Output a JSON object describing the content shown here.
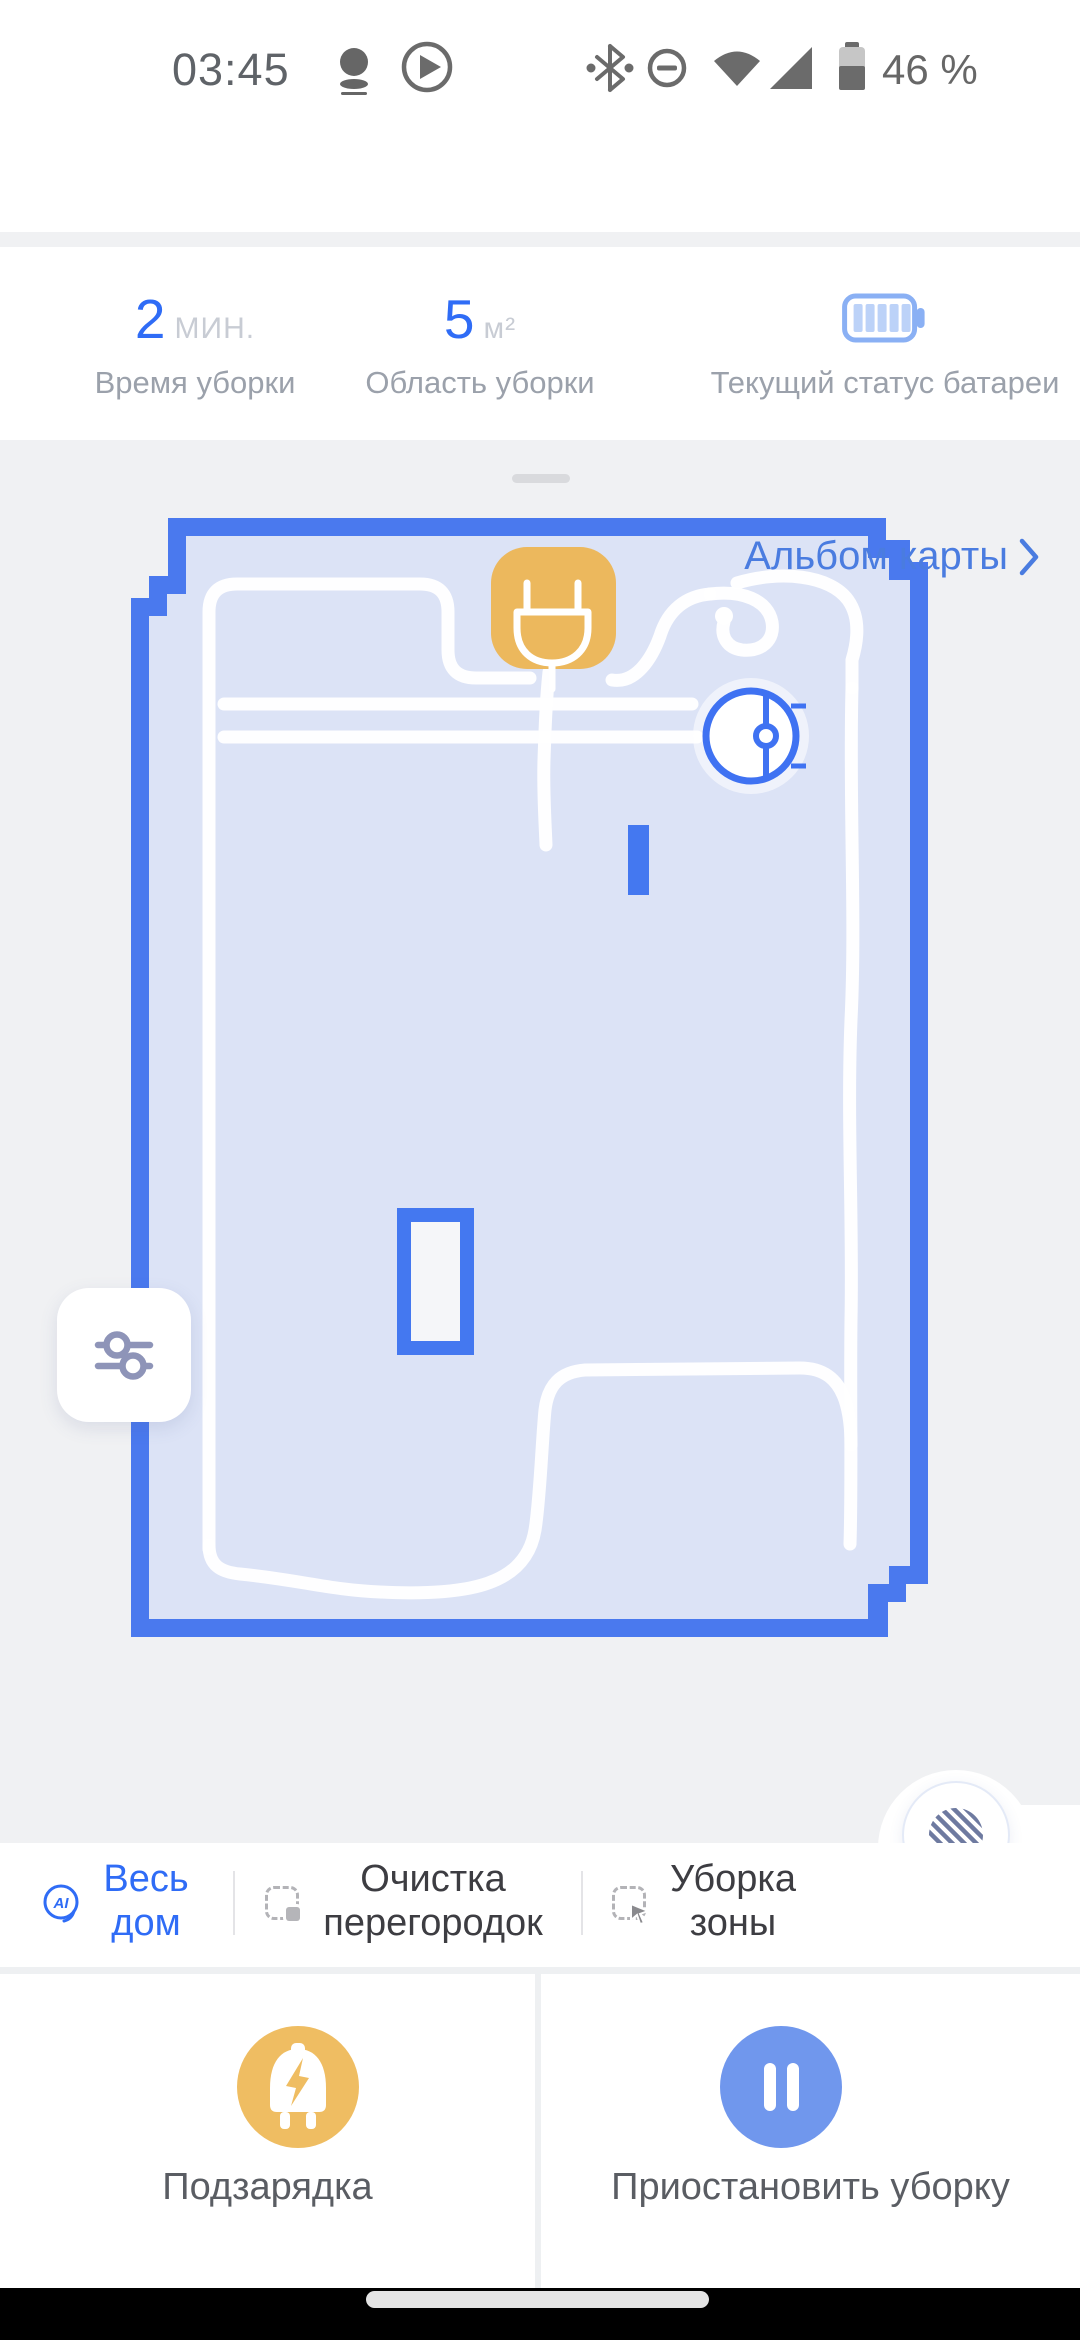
{
  "status_bar": {
    "time": "03:45",
    "battery_percent": "46 %",
    "icons": [
      "robot-notification-icon",
      "play-circle-icon",
      "bluetooth-icon",
      "do-not-disturb-icon",
      "wifi-icon",
      "cell-signal-icon",
      "battery-icon"
    ]
  },
  "header": {
    "title": "Уборка всего дома"
  },
  "stats": {
    "items": [
      {
        "value": "2",
        "unit": "МИН.",
        "label": "Время уборки"
      },
      {
        "value": "5",
        "unit": "м²",
        "label": "Область уборки"
      },
      {
        "value": "",
        "unit": "",
        "label": "Текущий статус батареи",
        "icon": "battery-level-icon"
      }
    ]
  },
  "map": {
    "album_link_label": "Альбом карты",
    "icons": {
      "dock": "charging-dock-icon",
      "robot": "robot-vacuum-icon",
      "filter": "map-filter-icon",
      "stripes": "stripes-mode-icon"
    }
  },
  "tabs": {
    "ai_badge_text": "AI",
    "items": [
      {
        "line1": "Весь",
        "line2": "дом"
      },
      {
        "line1": "Очистка",
        "line2": "перегородок"
      },
      {
        "line1": "Уборка",
        "line2": "зоны"
      }
    ]
  },
  "actions": {
    "recharge_label": "Подзарядка",
    "pause_label": "Приостановить уборку"
  },
  "colors": {
    "accent_blue": "#2f6cf6",
    "link_blue": "#4a7ce0",
    "map_border": "#4a79ee",
    "map_fill": "#dce3f6",
    "dock_orange": "#ecb85d",
    "action_orange": "#efbd62",
    "action_blue": "#7097ed",
    "background_gray": "#f0f1f3"
  }
}
